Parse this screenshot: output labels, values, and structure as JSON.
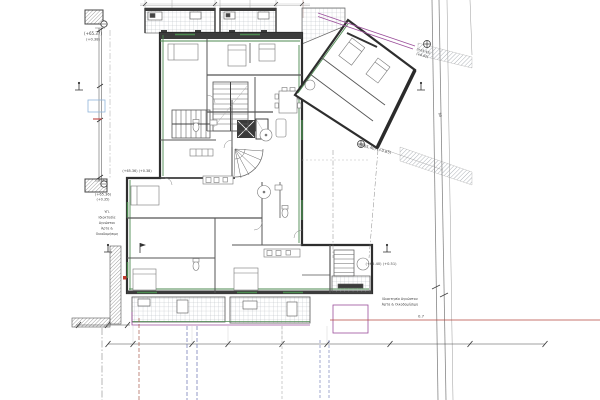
{
  "page": {
    "background": "#ffffff"
  },
  "drawing": {
    "type": "architectural-floor-plan",
    "annotations": {
      "level_top_left_line1": "(+65.37)",
      "level_top_left_line2": "(+0.38)",
      "level_west_wall": "(+65.36) (+0.38)",
      "level_bottom_left_line1": "(+65.36)",
      "level_bottom_left_line2": "(+0.35)",
      "level_wing_edge": "(+65.40) (+0.65)",
      "level_road_line1": "(+65.45)",
      "level_road_line2": "(+0.62)",
      "level_south_east": "(+65.40) (+0.51)",
      "note_left_line1": "ΥΠ.",
      "note_left_line2": "Ιδιοκτησία",
      "note_left_line3": "Αγνώστου",
      "note_left_line4": "Άρτα &",
      "note_left_line5": "Οικοδομήσιμη",
      "note_right_line1": "Ιδιοκτησία Αγνώστου",
      "note_right_line2": "Άρτα & Οικοδομήσιμη",
      "dim_road_width": "80",
      "dim_boundary_offset": "0.7"
    },
    "colors": {
      "walls": "#2e2e2e",
      "insulation": "#4c8a50",
      "boundary": "#9b4f9b",
      "survey_red": "#b5493f",
      "grid_blue": "#6670b0",
      "hatch": "#9aa1a8"
    }
  }
}
